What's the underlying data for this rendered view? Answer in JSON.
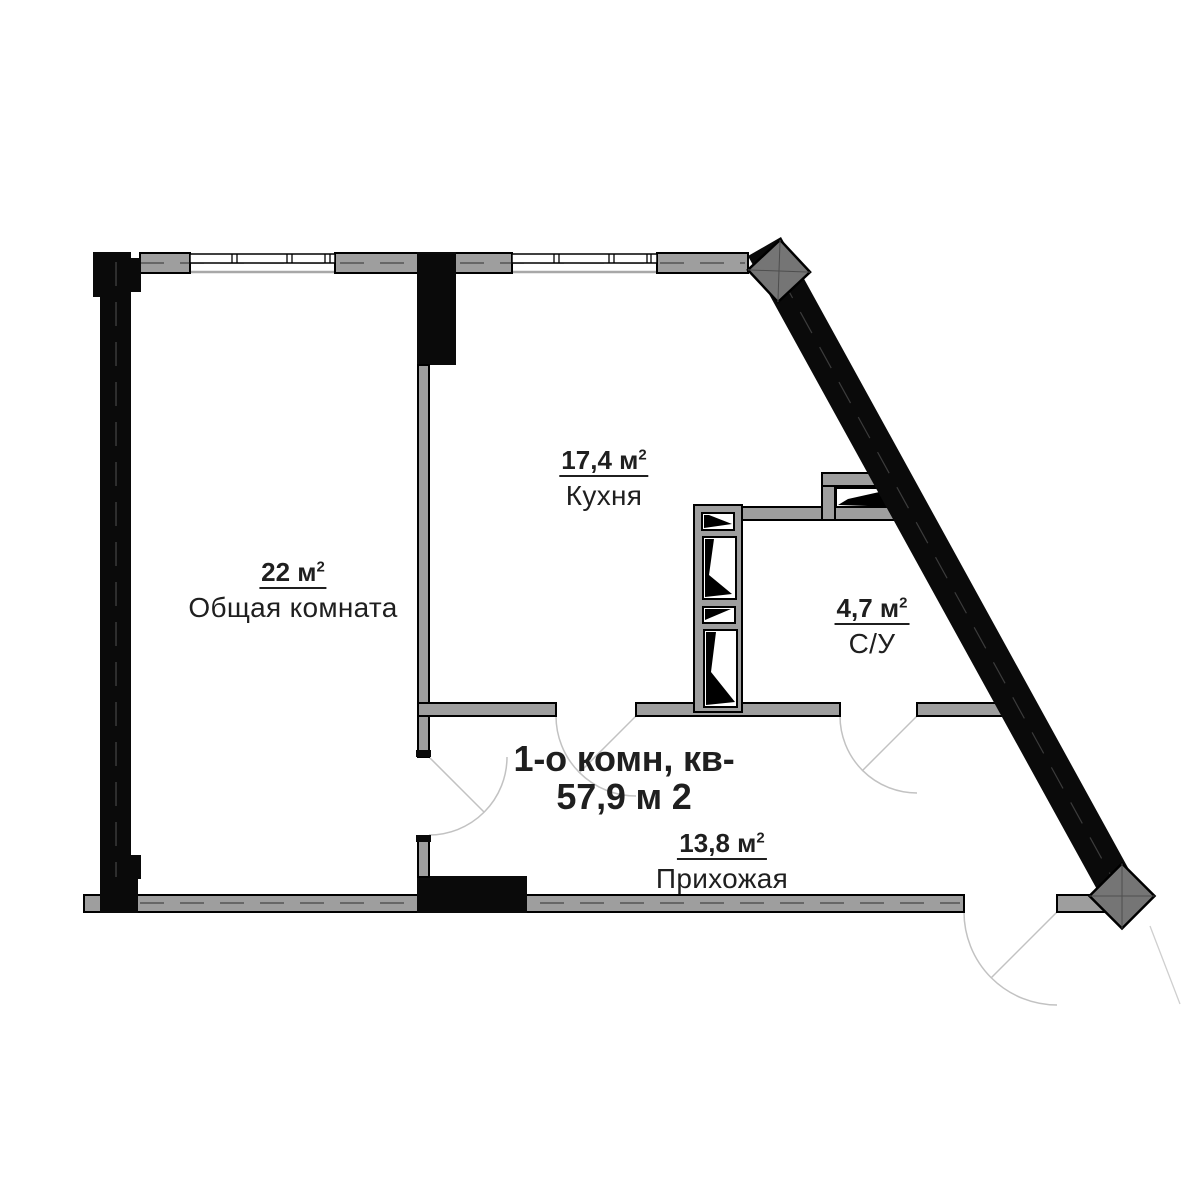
{
  "plan": {
    "title": {
      "line1": "1-о комн, кв-",
      "line2": "57,9 м 2"
    },
    "rooms": [
      {
        "id": "living",
        "area": "22 м",
        "area_sup": "2",
        "name": "Общая комната"
      },
      {
        "id": "kitchen",
        "area": "17,4 м",
        "area_sup": "2",
        "name": "Кухня"
      },
      {
        "id": "bathroom",
        "area": "4,7 м",
        "area_sup": "2",
        "name": "С/У"
      },
      {
        "id": "hallway",
        "area": "13,8 м",
        "area_sup": "2",
        "name": "Прихожая"
      }
    ]
  },
  "colors": {
    "wall_black": "#0a0a0a",
    "wall_gray": "#9e9e9e",
    "column_gray": "#757575",
    "door_arc": "#c2c2c2",
    "text": "#1f1f1f",
    "background": "#ffffff"
  }
}
